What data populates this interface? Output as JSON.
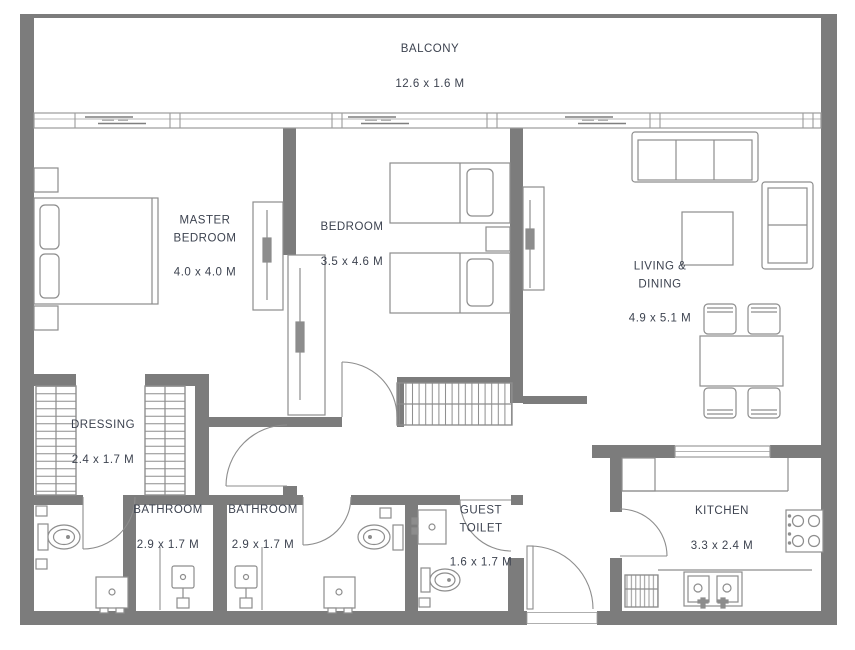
{
  "colors": {
    "wall": "#7c7c7c",
    "furniture_line": "#8d8d8d",
    "thin_line": "#9b9b9b",
    "label_text": "#3d4350",
    "background": "#ffffff"
  },
  "rooms": [
    {
      "id": "balcony",
      "name": "BALCONY",
      "dims": "12.6 x 1.6 M"
    },
    {
      "id": "master-bedroom",
      "name": "MASTER\nBEDROOM",
      "dims": "4.0 x 4.0 M"
    },
    {
      "id": "bedroom",
      "name": "BEDROOM",
      "dims": "3.5 x 4.6 M"
    },
    {
      "id": "living-dining",
      "name": "LIVING &\nDINING",
      "dims": "4.9 x 5.1 M"
    },
    {
      "id": "dressing",
      "name": "DRESSING",
      "dims": "2.4 x 1.7 M"
    },
    {
      "id": "bathroom-1",
      "name": "BATHROOM",
      "dims": "2.9 x 1.7 M"
    },
    {
      "id": "bathroom-2",
      "name": "BATHROOM",
      "dims": "2.9 x 1.7 M"
    },
    {
      "id": "guest-toilet",
      "name": "GUEST\nTOILET",
      "dims": "1.6 x 1.7 M"
    },
    {
      "id": "kitchen",
      "name": "KITCHEN",
      "dims": "3.3 x 2.4 M"
    }
  ]
}
